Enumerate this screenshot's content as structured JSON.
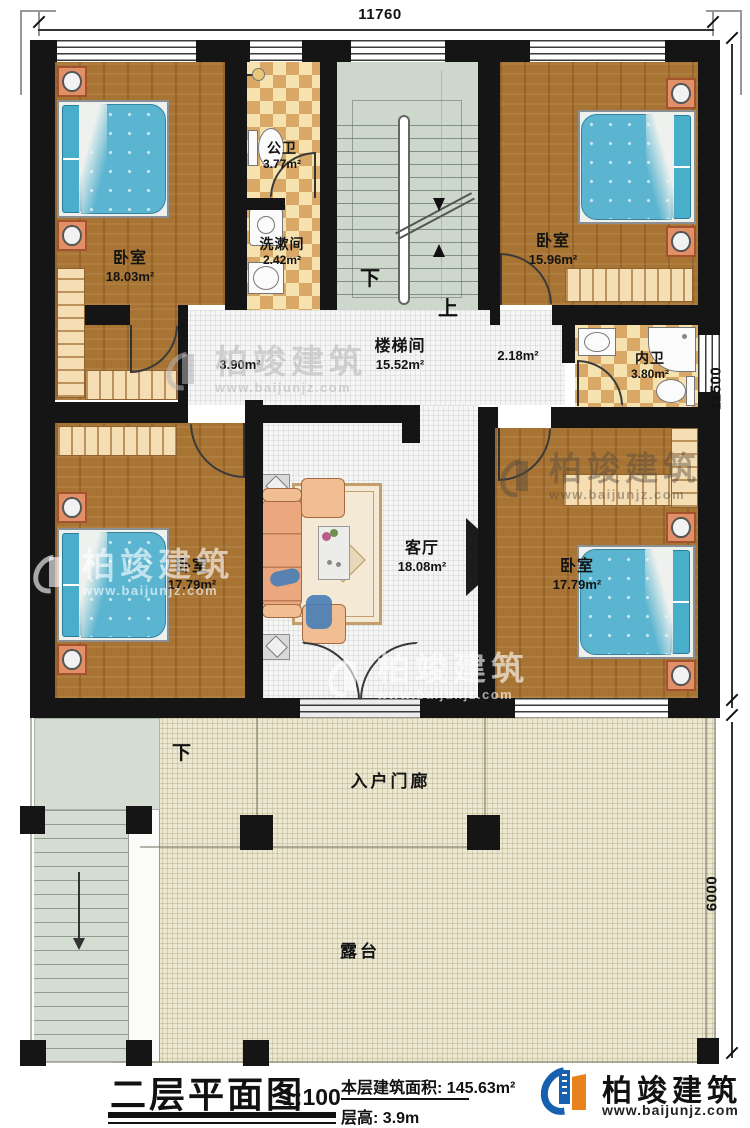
{
  "rooms": {
    "bedroom_tl": {
      "name": "卧室",
      "area": "18.03m²"
    },
    "public_bath": {
      "name": "公卫",
      "area": "3.77m²"
    },
    "washroom": {
      "name": "洗漱间",
      "area": "2.42m²"
    },
    "bedroom_tr": {
      "name": "卧室",
      "area": "15.96m²"
    },
    "stairwell": {
      "name": "楼梯间",
      "area": "15.52m²"
    },
    "hall_left": {
      "area": "3.90m²"
    },
    "hall_right": {
      "area": "2.18m²"
    },
    "ensuite": {
      "name": "内卫",
      "area": "3.80m²"
    },
    "bedroom_bl": {
      "name": "卧室",
      "area": "17.79m²"
    },
    "living": {
      "name": "客厅",
      "area": "18.08m²"
    },
    "bedroom_br": {
      "name": "卧室",
      "area": "17.79m²"
    },
    "porch": {
      "name": "入户门廊"
    },
    "terrace": {
      "name": "露台"
    }
  },
  "nav": {
    "up": "上",
    "down": "下",
    "terrace_down": "下"
  },
  "dims": {
    "top": "11760",
    "right": "11500",
    "terrace": "6000"
  },
  "title_block": {
    "title": "二层平面图",
    "scale": "1:100",
    "area_label": "本层建筑面积:",
    "area_value": "145.63m²",
    "floor_height_label": "层高:",
    "floor_height_value": "3.9m"
  },
  "brand": {
    "name": "柏竣建筑",
    "site": "www.baijunjz.com"
  },
  "watermark": {
    "name": "柏竣建筑",
    "site": "www.baijunjz.com"
  },
  "colors": {
    "wall": "#151515",
    "wood_floor": "#a87434",
    "tile": "#d9a766",
    "bed": "#5cb5d0",
    "stair": "#cdd7cc",
    "terrace": "#ece7d0",
    "brand_blue": "#1660ad",
    "brand_orange": "#e8821c"
  }
}
